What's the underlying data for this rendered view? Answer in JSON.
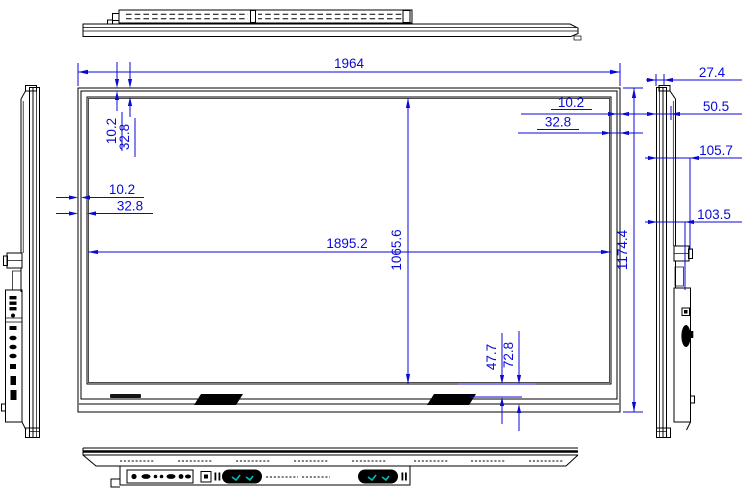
{
  "drawing": {
    "colors": {
      "outline": "#000000",
      "dimension": "#0a0ad8",
      "speaker_accent": "#00bcbc"
    },
    "front_view": {
      "overall_width": "1964",
      "overall_height": "1174.4",
      "active_area_width": "1895.2",
      "active_area_height": "1065.6",
      "bezel_top": {
        "a": "10.2",
        "b": "32.8"
      },
      "bezel_left": {
        "a": "10.2",
        "b": "32.8"
      },
      "bezel_right": {
        "a": "10.2",
        "b": "32.8"
      },
      "bezel_bottom": {
        "a": "47.7",
        "b": "72.8"
      }
    },
    "side_view": {
      "panel_depth": "27.4",
      "front_section_depth": "50.5",
      "handle_depth": "105.7",
      "back_box_depth": "103.5"
    }
  }
}
